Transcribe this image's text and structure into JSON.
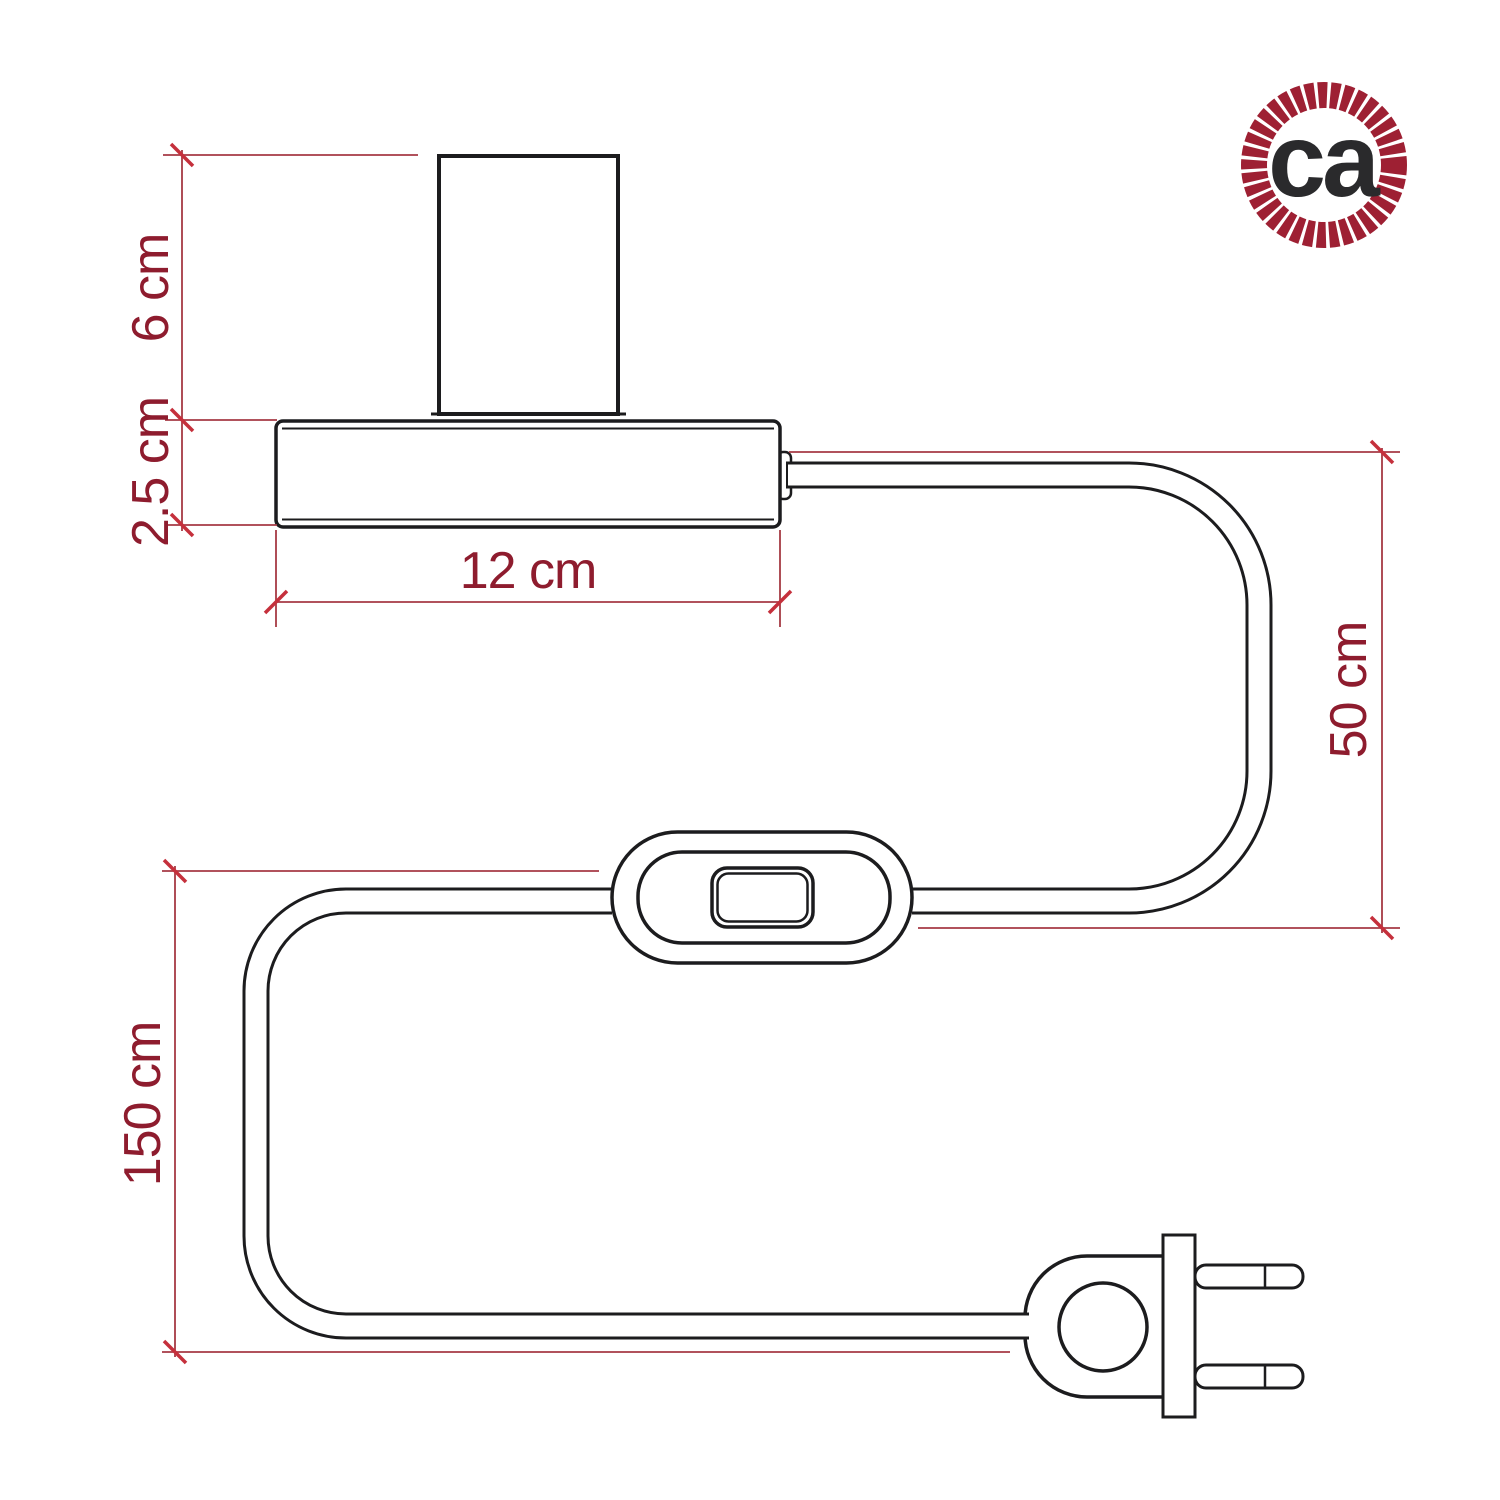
{
  "diagram": {
    "type": "product-dimension-drawing",
    "labels": {
      "socket_height": "6 cm",
      "base_height": "2.5 cm",
      "base_width": "12 cm",
      "cable_base_to_switch": "50 cm",
      "cable_switch_to_plug": "150 cm"
    },
    "colors": {
      "drawing_line": "#1c1c1e",
      "dimension_line": "#a63a44",
      "tick": "#c5303c",
      "dimension_text": "#8e1c2e",
      "background": "#ffffff"
    }
  },
  "logo": {
    "text": "ca",
    "ring_color": "#9e2033",
    "text_color": "#2a2a2c"
  }
}
